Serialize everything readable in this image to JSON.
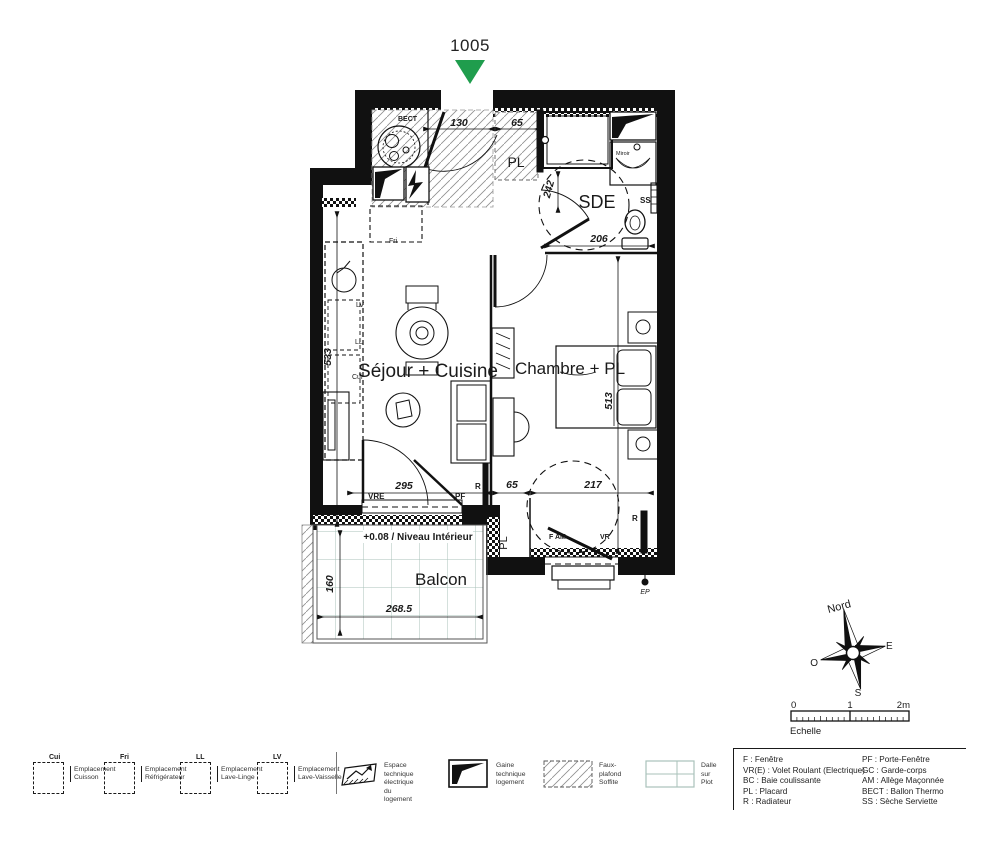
{
  "marker": {
    "unit": "1005"
  },
  "colors": {
    "marker_green": "#1f9d4d",
    "plot_grid": "#a9c2ba",
    "line": "#111111"
  },
  "plan": {
    "rooms": {
      "sejour": "Séjour + Cuisine",
      "chambre": "Chambre + PL",
      "sde": "SDE",
      "balcon": "Balcon",
      "pl_entry": "PL",
      "pl_bottom": "PL"
    },
    "labels": {
      "bect": "BECT",
      "fri": "Fri",
      "lv": "LV",
      "ll": "LL",
      "cui": "Cui",
      "vre": "VRE",
      "pf": "PF",
      "r_sejour": "R",
      "r_chambre": "R",
      "f_am": "F AM",
      "vr": "VR",
      "ss": "SS",
      "miroir": "Miroir",
      "ep": "EP",
      "niveau": "+0.08 / Niveau Intérieur"
    },
    "dims": {
      "entry_width": "130",
      "pl_top_width": "65",
      "sde_door": "242",
      "sde_width": "206",
      "sejour_height": "533",
      "chambre_height": "513",
      "sejour_width": "295",
      "pl_bottom_width": "65",
      "chambre_width": "217",
      "balcon_depth": "160",
      "balcon_width": "268.5"
    }
  },
  "compass": {
    "n": "Nord",
    "e": "E",
    "s": "S",
    "w": "O"
  },
  "scalebar": {
    "zero": "0",
    "one": "1",
    "two": "2m",
    "label": "Echelle"
  },
  "legend": {
    "placements": [
      {
        "tag": "Cui",
        "line1": "Emplacement",
        "line2": "Cuisson"
      },
      {
        "tag": "Fri",
        "line1": "Emplacement",
        "line2": "Réfrigérateur"
      },
      {
        "tag": "LL",
        "line1": "Emplacement",
        "line2": "Lave-Linge"
      },
      {
        "tag": "LV",
        "line1": "Emplacement",
        "line2": "Lave-Vaisselle"
      }
    ],
    "symbols": [
      {
        "line1": "Espace technique",
        "line2": "électrique du logement"
      },
      {
        "line1": "Gaine technique",
        "line2": "logement"
      },
      {
        "line1": "Faux-plafond",
        "line2": "Soffite"
      },
      {
        "line1": "Dalle",
        "line2": "sur Plot"
      }
    ],
    "abbr1": [
      "F : Fenêtre",
      "VR(E) : Volet Roulant (Electrique)",
      "BC : Baie coulissante",
      "PL : Placard",
      "R : Radiateur"
    ],
    "abbr2": [
      "PF : Porte-Fenêtre",
      "GC : Garde-corps",
      "AM : Allège Maçonnée",
      "BECT : Ballon Thermo",
      "SS : Sèche Serviette"
    ]
  }
}
